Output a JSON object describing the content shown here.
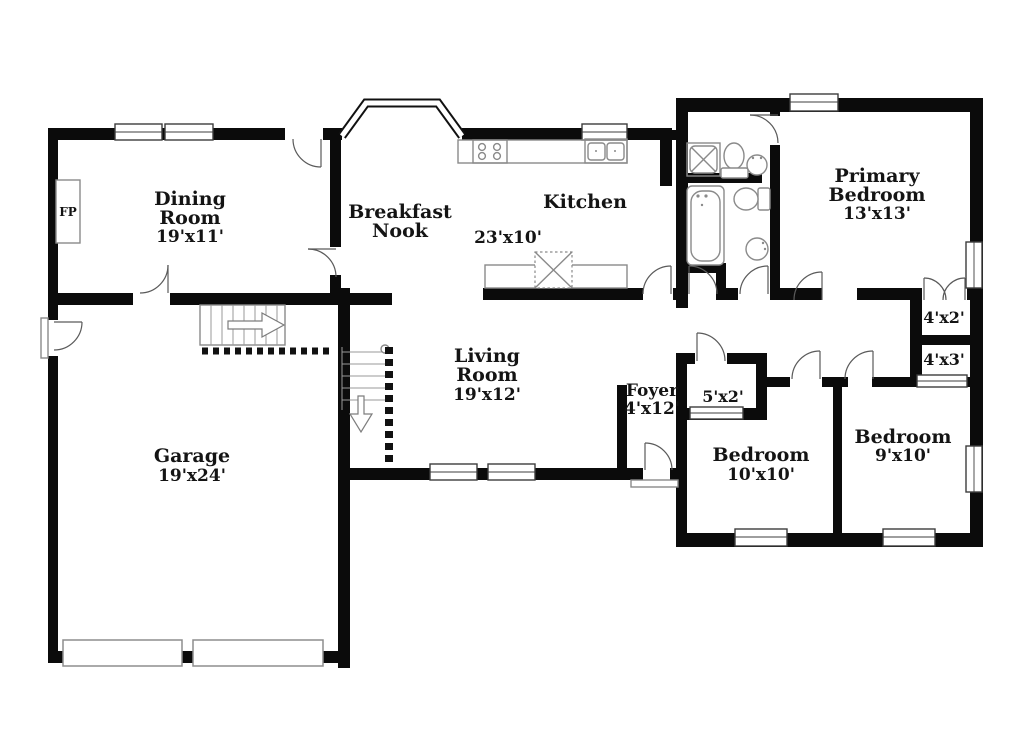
{
  "floor_plan": {
    "rooms": {
      "dining": {
        "line1": "Dining",
        "line2": "Room",
        "dims": "19'x11'"
      },
      "nook": {
        "line1": "Breakfast",
        "line2": "Nook"
      },
      "kitchen": {
        "name": "Kitchen",
        "dims": "23'x10'"
      },
      "primary": {
        "line1": "Primary",
        "line2": "Bedroom",
        "dims": "13'x13'"
      },
      "living": {
        "line1": "Living",
        "line2": "Room",
        "dims": "19'x12'"
      },
      "foyer": {
        "name": "Foyer",
        "dims": "4'x12'"
      },
      "bedroom10": {
        "name": "Bedroom",
        "dims": "10'x10'"
      },
      "bedroom9": {
        "name": "Bedroom",
        "dims": "9'x10'"
      },
      "garage": {
        "name": "Garage",
        "dims": "19'x24'"
      },
      "closet_4x2": {
        "dims": "4'x2'"
      },
      "closet_4x3": {
        "dims": "4'x3'"
      },
      "closet_5x2": {
        "dims": "5'x2'"
      },
      "fireplace": {
        "label": "FP"
      }
    },
    "colors": {
      "wall": "#0b0b0b",
      "fixture_line": "#8a8a8a",
      "text": "#141414",
      "background": "#ffffff"
    }
  }
}
